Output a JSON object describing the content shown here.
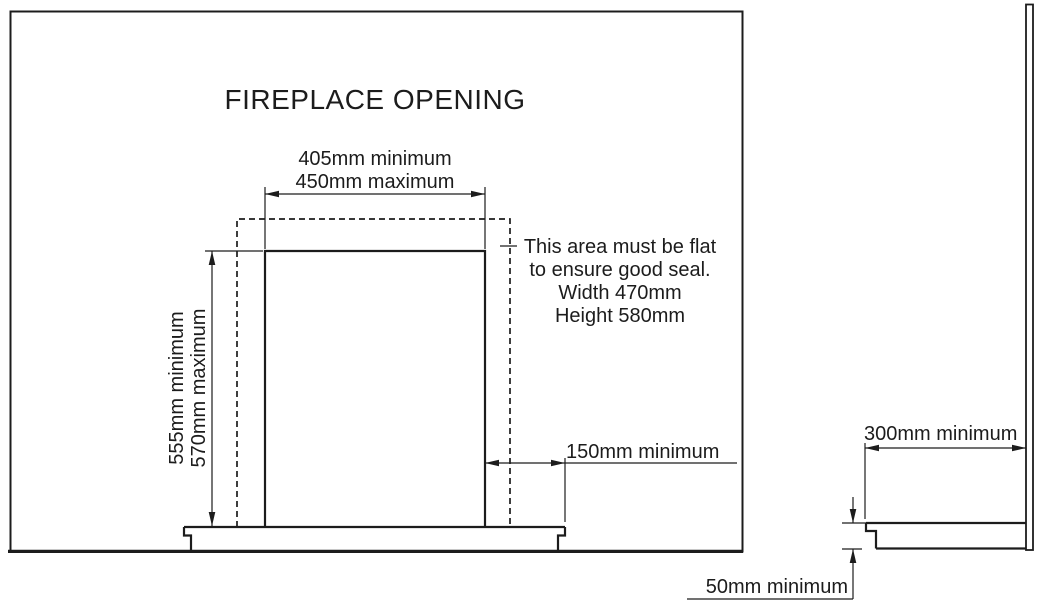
{
  "diagram": {
    "title": "FIREPLACE OPENING",
    "front_view": {
      "width_dimension": {
        "line1": "405mm minimum",
        "line2": "450mm maximum"
      },
      "height_dimension": {
        "line1": "555mm minimum",
        "line2": "570mm maximum"
      },
      "side_clearance_dimension": "150mm minimum",
      "seal_note": {
        "line1": "This area must be flat",
        "line2": "to ensure good seal.",
        "line3": "Width 470mm",
        "line4": "Height 580mm"
      }
    },
    "side_view": {
      "hearth_depth_dimension": "300mm minimum",
      "hearth_thickness_dimension": "50mm minimum"
    },
    "colors": {
      "ink": "#1c1c1c",
      "background": "#ffffff"
    }
  }
}
